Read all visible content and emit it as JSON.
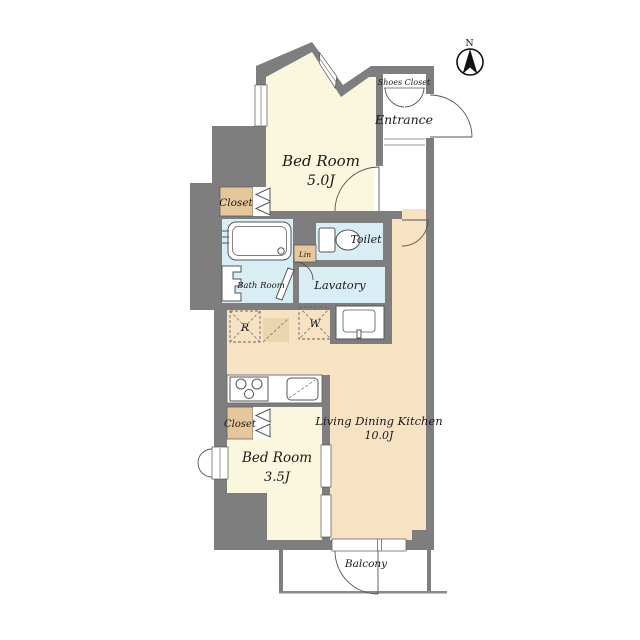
{
  "plan": {
    "compass_label": "N",
    "rooms": {
      "bedroom_main": {
        "label": "Bed Room",
        "size": "5.0J"
      },
      "entrance": {
        "label": "Entrance"
      },
      "shoes_closet": {
        "label": "Shoes Closet"
      },
      "closet_upper": {
        "label": "Closet"
      },
      "bath": {
        "label": "Bath Room"
      },
      "linen": {
        "label": "Lin"
      },
      "toilet": {
        "label": "Toilet"
      },
      "lavatory": {
        "label": "Lavatory"
      },
      "refrigerator_space": {
        "label": "R"
      },
      "washer_space": {
        "label": "W"
      },
      "ldk": {
        "label": "Living Dining Kitchen",
        "size": "10.0J"
      },
      "closet_lower": {
        "label": "Closet"
      },
      "bedroom_small": {
        "label": "Bed Room",
        "size": "3.5J"
      },
      "balcony": {
        "label": "Balcony"
      }
    },
    "colors": {
      "wall_gray": "#7E7E7E",
      "bedroom_cream": "#FAF7DE",
      "ldk_peach": "#F8E2C4",
      "wet_area_blue": "#D9EDF4",
      "closet_tan": "#E5C79B",
      "outline": "#555555",
      "text": "#1A1A1A"
    }
  }
}
